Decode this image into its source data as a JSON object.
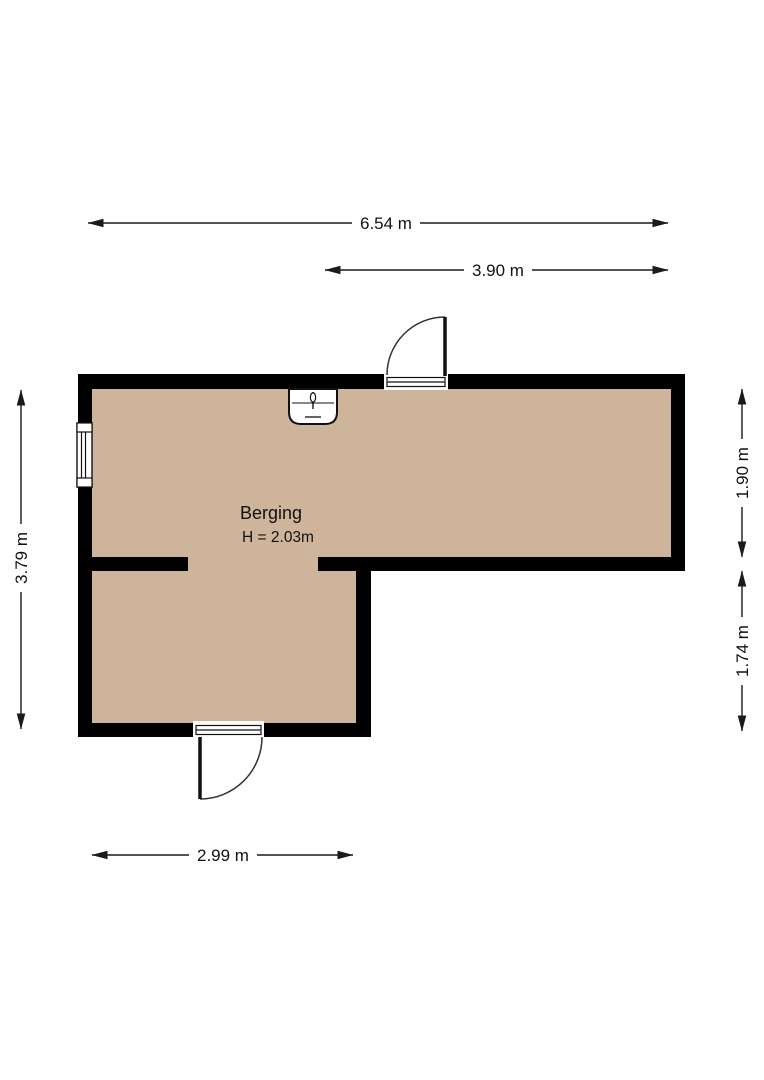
{
  "floorplan": {
    "room": {
      "name": "Berging",
      "ceiling_height": "H = 2.03m"
    },
    "dimensions": {
      "top_total": "6.54 m",
      "top_right": "3.90 m",
      "left": "3.79 m",
      "right_upper": "1.90 m",
      "right_lower": "1.74 m",
      "bottom": "2.99 m"
    },
    "colors": {
      "floor": "#cdb49a",
      "wall": "#000000",
      "dimension": "#1a1a1a"
    }
  }
}
